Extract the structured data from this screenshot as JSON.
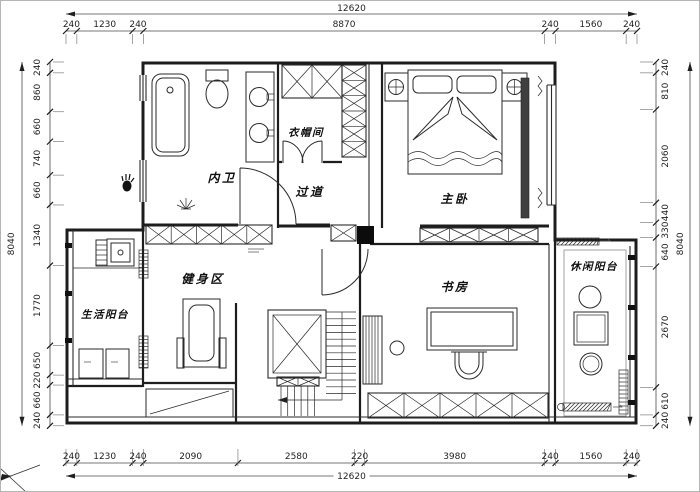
{
  "drawing": {
    "type": "floor-plan",
    "colors": {
      "line": "#1d1d1d",
      "background": "#ffffff",
      "column_fill": "#0c0c0c",
      "tv_bar_fill": "#3f3f3f"
    }
  },
  "rooms": {
    "bath": "内卫",
    "cloakroom": "衣帽间",
    "corridor": "过道",
    "master_bedroom": "主卧",
    "gym": "健身区",
    "study": "书房",
    "life_balcony": "生活阳台",
    "leisure_balcony": "休闲阳台"
  },
  "dimensions": {
    "top": {
      "total": "12620",
      "segments": [
        "240",
        "1230",
        "240",
        "8870",
        "240",
        "1560",
        "240"
      ]
    },
    "bottom": {
      "total": "12620",
      "segments": [
        "240",
        "1230",
        "240",
        "2090",
        "2580",
        "220",
        "3980",
        "240",
        "1560",
        "240"
      ]
    },
    "left": {
      "total": "8040",
      "segments": [
        "240",
        "860",
        "660",
        "740",
        "660",
        "1340",
        "1770",
        "650",
        "220",
        "660",
        "240"
      ]
    },
    "right": {
      "total": "8040",
      "segments": [
        "240",
        "810",
        "2060",
        "440",
        "330",
        "640",
        "2670",
        "610",
        "240"
      ]
    }
  }
}
